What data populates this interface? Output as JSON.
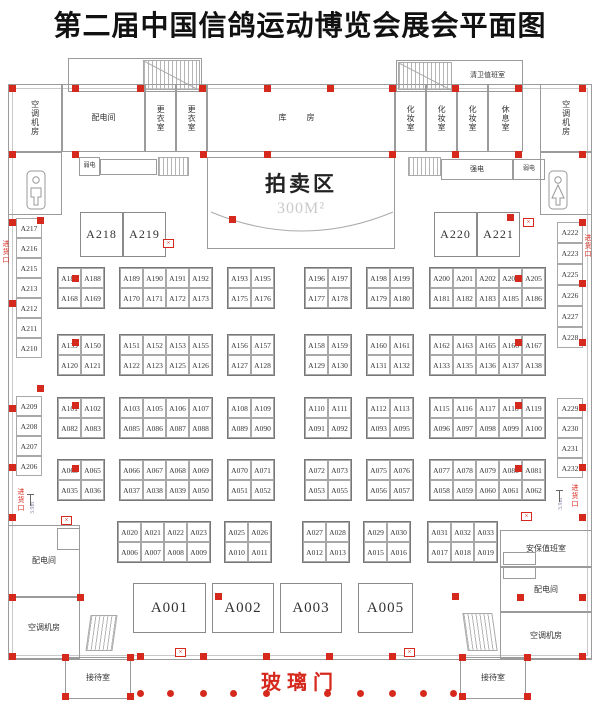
{
  "title": "第二届中国信鸽运动博览会展会平面图",
  "rooms": {
    "ac_top_left": "空调机房",
    "power_top": "配电间",
    "changing_1": "更衣室",
    "changing_2": "更衣室",
    "warehouse": "库 房",
    "makeup_1": "化妆室",
    "makeup_2": "化妆室",
    "makeup_3": "化妆室",
    "rest_room": "休息室",
    "ac_top_right": "空调机房",
    "cleaning_duty": "清卫值班室",
    "weak_elec_left": "弱电",
    "strong_elec": "强电",
    "weak_elec_right": "弱电",
    "auction_area": "拍卖区",
    "auction_size": "300M²",
    "power_bottom_left": "配电间",
    "ac_bottom_left": "空调机房",
    "security_duty": "安保值班室",
    "power_bottom_right": "配电间",
    "ac_bottom_right": "空调机房",
    "reception_left": "接待室",
    "reception_right": "接待室",
    "glass_door": "玻璃门",
    "goods_entrance_left_top": "进货口",
    "goods_entrance_left_bottom": "进货口",
    "goods_entrance_right_top": "进货口",
    "goods_entrance_right_bottom": "进货口",
    "dim_left": "3.9m",
    "dim_right": "3.9m"
  },
  "booths": {
    "left_column_top": [
      "A217",
      "A216",
      "A215",
      "A213",
      "A212",
      "A211",
      "A210"
    ],
    "left_column_bottom": [
      "A209",
      "A208",
      "A207",
      "A206"
    ],
    "right_column_top": [
      "A222",
      "A223",
      "A225",
      "A226",
      "A227",
      "A228"
    ],
    "right_column_bottom": [
      "A229",
      "A230",
      "A231",
      "A232"
    ],
    "large_top_left": [
      "A218",
      "A219"
    ],
    "large_top_right": [
      "A220",
      "A221"
    ],
    "large_bottom": [
      "A001",
      "A002",
      "A003",
      "A005"
    ],
    "rows": [
      {
        "blocks": [
          {
            "top": [
              "A187",
              "A188"
            ],
            "bottom": [
              "A168",
              "A169"
            ]
          },
          {
            "top": [
              "A189",
              "A190",
              "A191",
              "A192"
            ],
            "bottom": [
              "A170",
              "A171",
              "A172",
              "A173"
            ]
          },
          {
            "top": [
              "A193",
              "A195"
            ],
            "bottom": [
              "A175",
              "A176"
            ]
          },
          {
            "top": [
              "A196",
              "A197"
            ],
            "bottom": [
              "A177",
              "A178"
            ]
          },
          {
            "top": [
              "A198",
              "A199"
            ],
            "bottom": [
              "A179",
              "A180"
            ]
          },
          {
            "top": [
              "A200",
              "A201",
              "A202",
              "A203",
              "A205"
            ],
            "bottom": [
              "A181",
              "A182",
              "A183",
              "A185",
              "A186"
            ]
          }
        ]
      },
      {
        "blocks": [
          {
            "top": [
              "A139",
              "A150"
            ],
            "bottom": [
              "A120",
              "A121"
            ]
          },
          {
            "top": [
              "A151",
              "A152",
              "A153",
              "A155"
            ],
            "bottom": [
              "A122",
              "A123",
              "A125",
              "A126"
            ]
          },
          {
            "top": [
              "A156",
              "A157"
            ],
            "bottom": [
              "A127",
              "A128"
            ]
          },
          {
            "top": [
              "A158",
              "A159"
            ],
            "bottom": [
              "A129",
              "A130"
            ]
          },
          {
            "top": [
              "A160",
              "A161"
            ],
            "bottom": [
              "A131",
              "A132"
            ]
          },
          {
            "top": [
              "A162",
              "A163",
              "A165",
              "A166",
              "A167"
            ],
            "bottom": [
              "A133",
              "A135",
              "A136",
              "A137",
              "A138"
            ]
          }
        ]
      },
      {
        "blocks": [
          {
            "top": [
              "A101",
              "A102"
            ],
            "bottom": [
              "A082",
              "A083"
            ]
          },
          {
            "top": [
              "A103",
              "A105",
              "A106",
              "A107"
            ],
            "bottom": [
              "A085",
              "A086",
              "A087",
              "A088"
            ]
          },
          {
            "top": [
              "A108",
              "A109"
            ],
            "bottom": [
              "A089",
              "A090"
            ]
          },
          {
            "top": [
              "A110",
              "A111"
            ],
            "bottom": [
              "A091",
              "A092"
            ]
          },
          {
            "top": [
              "A112",
              "A113"
            ],
            "bottom": [
              "A093",
              "A095"
            ]
          },
          {
            "top": [
              "A115",
              "A116",
              "A117",
              "A118",
              "A119"
            ],
            "bottom": [
              "A096",
              "A097",
              "A098",
              "A099",
              "A100"
            ]
          }
        ]
      },
      {
        "blocks": [
          {
            "top": [
              "A063",
              "A065"
            ],
            "bottom": [
              "A035",
              "A036"
            ]
          },
          {
            "top": [
              "A066",
              "A067",
              "A068",
              "A069"
            ],
            "bottom": [
              "A037",
              "A038",
              "A039",
              "A050"
            ]
          },
          {
            "top": [
              "A070",
              "A071"
            ],
            "bottom": [
              "A051",
              "A052"
            ]
          },
          {
            "top": [
              "A072",
              "A073"
            ],
            "bottom": [
              "A053",
              "A055"
            ]
          },
          {
            "top": [
              "A075",
              "A076"
            ],
            "bottom": [
              "A056",
              "A057"
            ]
          },
          {
            "top": [
              "A077",
              "A078",
              "A079",
              "A080",
              "A081"
            ],
            "bottom": [
              "A058",
              "A059",
              "A060",
              "A061",
              "A062"
            ]
          }
        ]
      },
      {
        "blocks": [
          {
            "top": [
              "A020",
              "A021",
              "A022",
              "A023"
            ],
            "bottom": [
              "A006",
              "A007",
              "A008",
              "A009"
            ]
          },
          {
            "top": [
              "A025",
              "A026"
            ],
            "bottom": [
              "A010",
              "A011"
            ]
          },
          {
            "top": [
              "A027",
              "A028"
            ],
            "bottom": [
              "A012",
              "A013"
            ]
          },
          {
            "top": [
              "A029",
              "A030"
            ],
            "bottom": [
              "A015",
              "A016"
            ]
          },
          {
            "top": [
              "A031",
              "A032",
              "A033"
            ],
            "bottom": [
              "A017",
              "A018",
              "A019"
            ]
          }
        ]
      }
    ]
  },
  "colors": {
    "accent_red": "#d6291e",
    "wall_gray": "#9b9b9b"
  }
}
